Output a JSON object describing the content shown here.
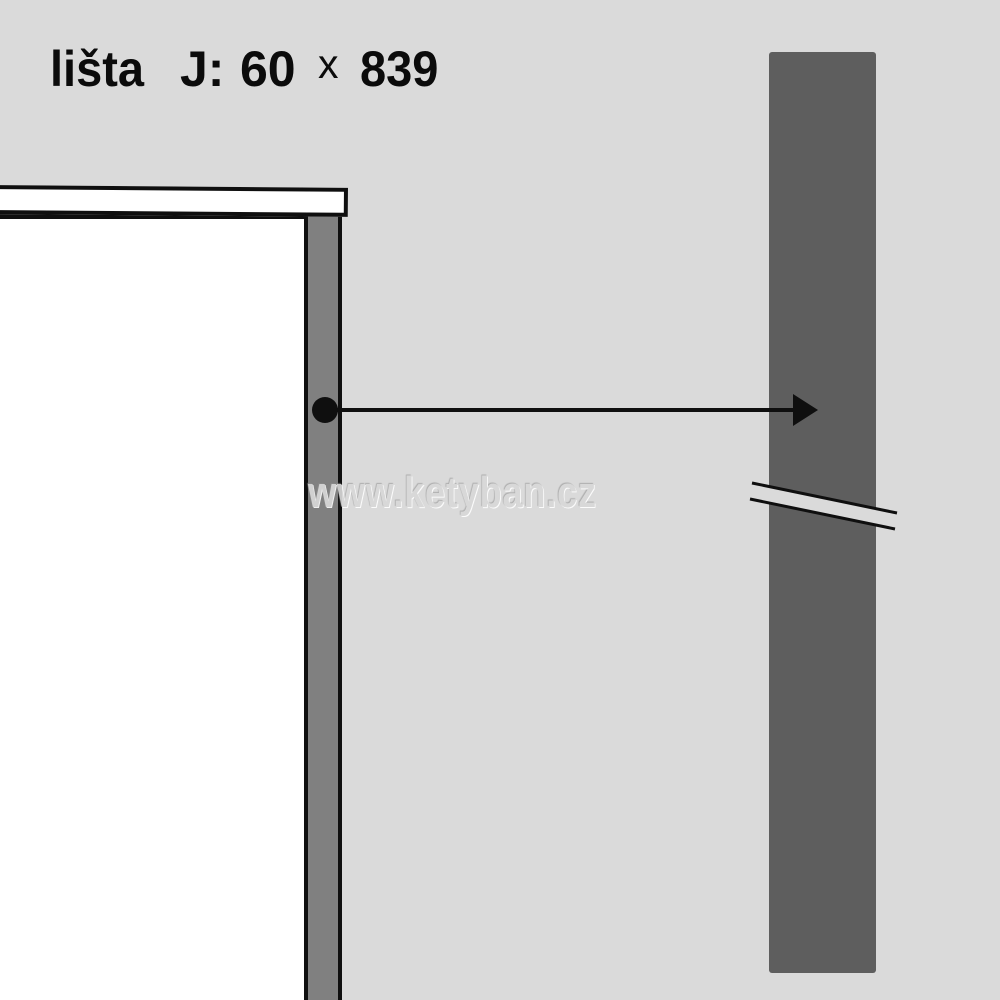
{
  "title": {
    "product": "lišta",
    "variant": "J:",
    "width": "60",
    "times": "x",
    "length": "839"
  },
  "watermark": {
    "text": "www.ketyban.cz"
  },
  "colors": {
    "background": "#dadada",
    "panel": "#ffffff",
    "strip": "#808080",
    "bar": "#5e5e5e",
    "outline": "#0f0f0f",
    "watermark": "#d8d8d8"
  },
  "icons": {
    "leader_dot": "filled-circle",
    "leader_arrowhead": "right-arrowhead",
    "break_mark": "double-slash-break"
  }
}
